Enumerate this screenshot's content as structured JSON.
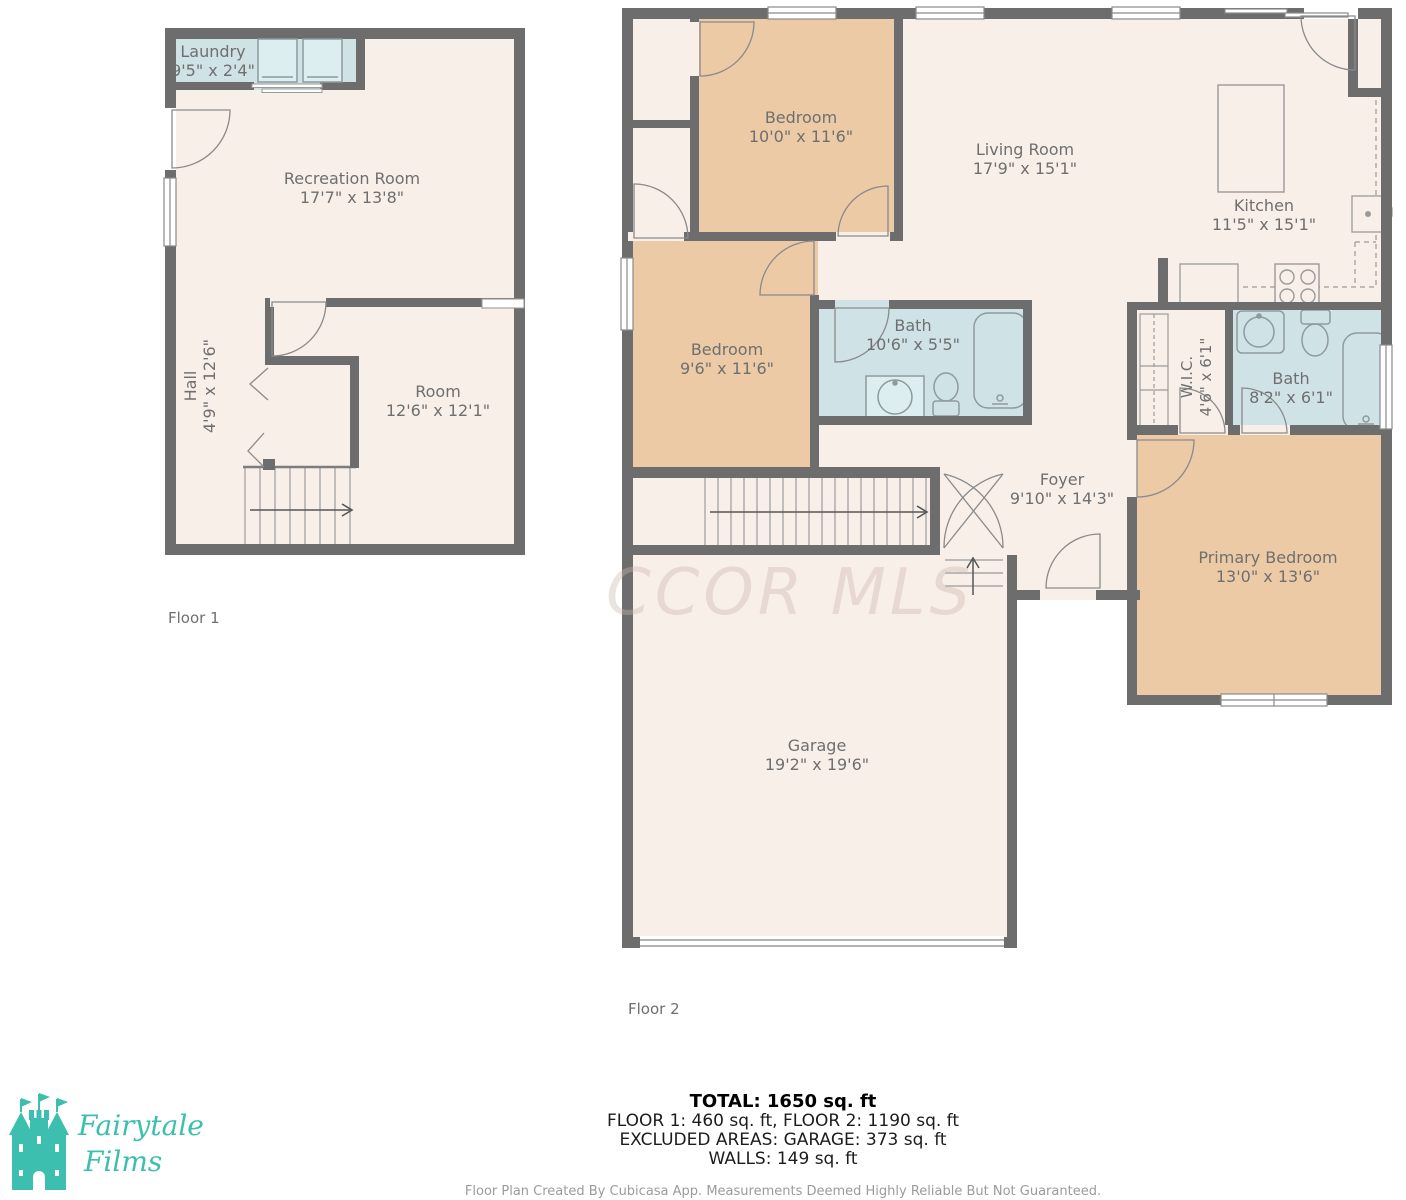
{
  "floor1": {
    "label": "Floor 1",
    "rooms": {
      "laundry": {
        "name": "Laundry",
        "dims": "9'5\" x 2'4\""
      },
      "recreation": {
        "name": "Recreation Room",
        "dims": "17'7\" x 13'8\""
      },
      "hall": {
        "name": "Hall",
        "dims": "4'9\" x 12'6\""
      },
      "room": {
        "name": "Room",
        "dims": "12'6\" x 12'1\""
      }
    }
  },
  "floor2": {
    "label": "Floor 2",
    "rooms": {
      "bedroom1": {
        "name": "Bedroom",
        "dims": "10'0\" x 11'6\""
      },
      "living": {
        "name": "Living Room",
        "dims": "17'9\" x 15'1\""
      },
      "kitchen": {
        "name": "Kitchen",
        "dims": "11'5\" x 15'1\""
      },
      "bedroom2": {
        "name": "Bedroom",
        "dims": "9'6\" x 11'6\""
      },
      "bath1": {
        "name": "Bath",
        "dims": "10'6\" x 5'5\""
      },
      "wic": {
        "name": "W.I.C.",
        "dims": "4'6\" x 6'1\""
      },
      "bath2": {
        "name": "Bath",
        "dims": "8'2\" x 6'1\""
      },
      "foyer": {
        "name": "Foyer",
        "dims": "9'10\" x 14'3\""
      },
      "primary": {
        "name": "Primary Bedroom",
        "dims": "13'0\" x 13'6\""
      },
      "garage": {
        "name": "Garage",
        "dims": "19'2\" x 19'6\""
      }
    }
  },
  "summary": {
    "total": "TOTAL: 1650 sq. ft",
    "floors": "FLOOR 1: 460 sq. ft, FLOOR 2: 1190 sq. ft",
    "excluded": "EXCLUDED AREAS: GARAGE: 373 sq. ft",
    "walls": "WALLS: 149 sq. ft"
  },
  "disclaimer": "Floor Plan Created By Cubicasa App. Measurements Deemed Highly Reliable But Not Guaranteed.",
  "watermark": "CCOR MLS",
  "logo": {
    "line1": "Fairytale",
    "line2": "Films"
  },
  "colors": {
    "wall": "#6d6d6d",
    "floor": "#f8efe9",
    "bedroom": "#eccaa6",
    "wet_room": "#cfe2e6",
    "logo_teal": "#3cbfae",
    "label_text": "#6f6f6f"
  }
}
